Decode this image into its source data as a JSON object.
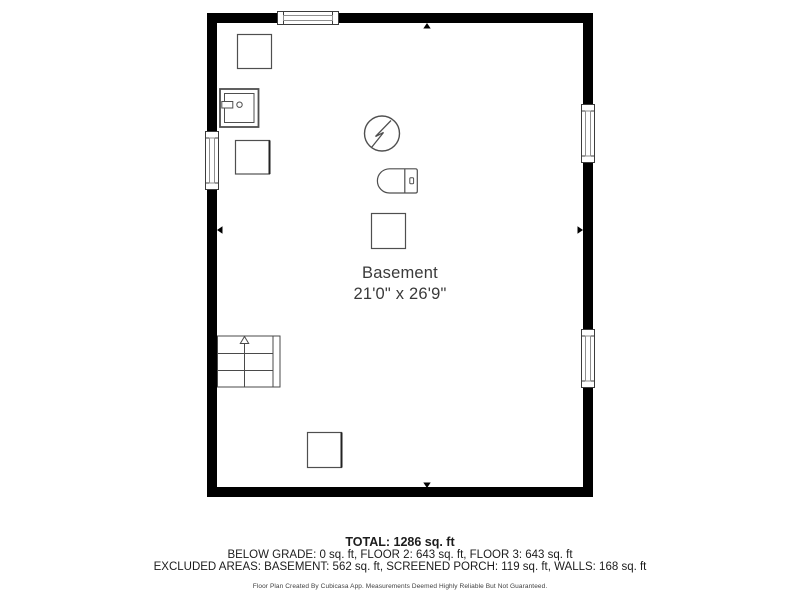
{
  "room": {
    "name": "Basement",
    "dimensions": "21'0\" x 26'9\""
  },
  "footer": {
    "total": "TOTAL: 1286 sq. ft",
    "floors": "BELOW GRADE: 0 sq. ft, FLOOR 2: 643 sq. ft, FLOOR 3: 643 sq. ft",
    "excluded_areas": "EXCLUDED AREAS: BASEMENT: 562 sq. ft, SCREENED PORCH: 119 sq. ft, WALLS: 168 sq. ft",
    "disclaimer": "Floor Plan Created By Cubicasa App. Measurements Deemed Highly Reliable But Not Guaranteed."
  },
  "colors": {
    "wall": "#000000",
    "fixture_stroke": "#4f4f4f",
    "window_frame": "#3c3c3c",
    "window_glass": "#8f8f8f",
    "room_text": "#3a3a3a",
    "footer_text": "#1c1c1c"
  },
  "fixtures": [
    {
      "icon": "storage-box-icon"
    },
    {
      "icon": "washing-machine-icon"
    },
    {
      "icon": "storage-box-icon"
    },
    {
      "icon": "electric-water-heater-icon"
    },
    {
      "icon": "toilet-icon"
    },
    {
      "icon": "storage-box-icon"
    },
    {
      "icon": "storage-box-icon"
    },
    {
      "icon": "staircase-up-icon"
    }
  ],
  "windows": [
    "top-wall",
    "left-wall",
    "right-wall-upper",
    "right-wall-lower"
  ]
}
